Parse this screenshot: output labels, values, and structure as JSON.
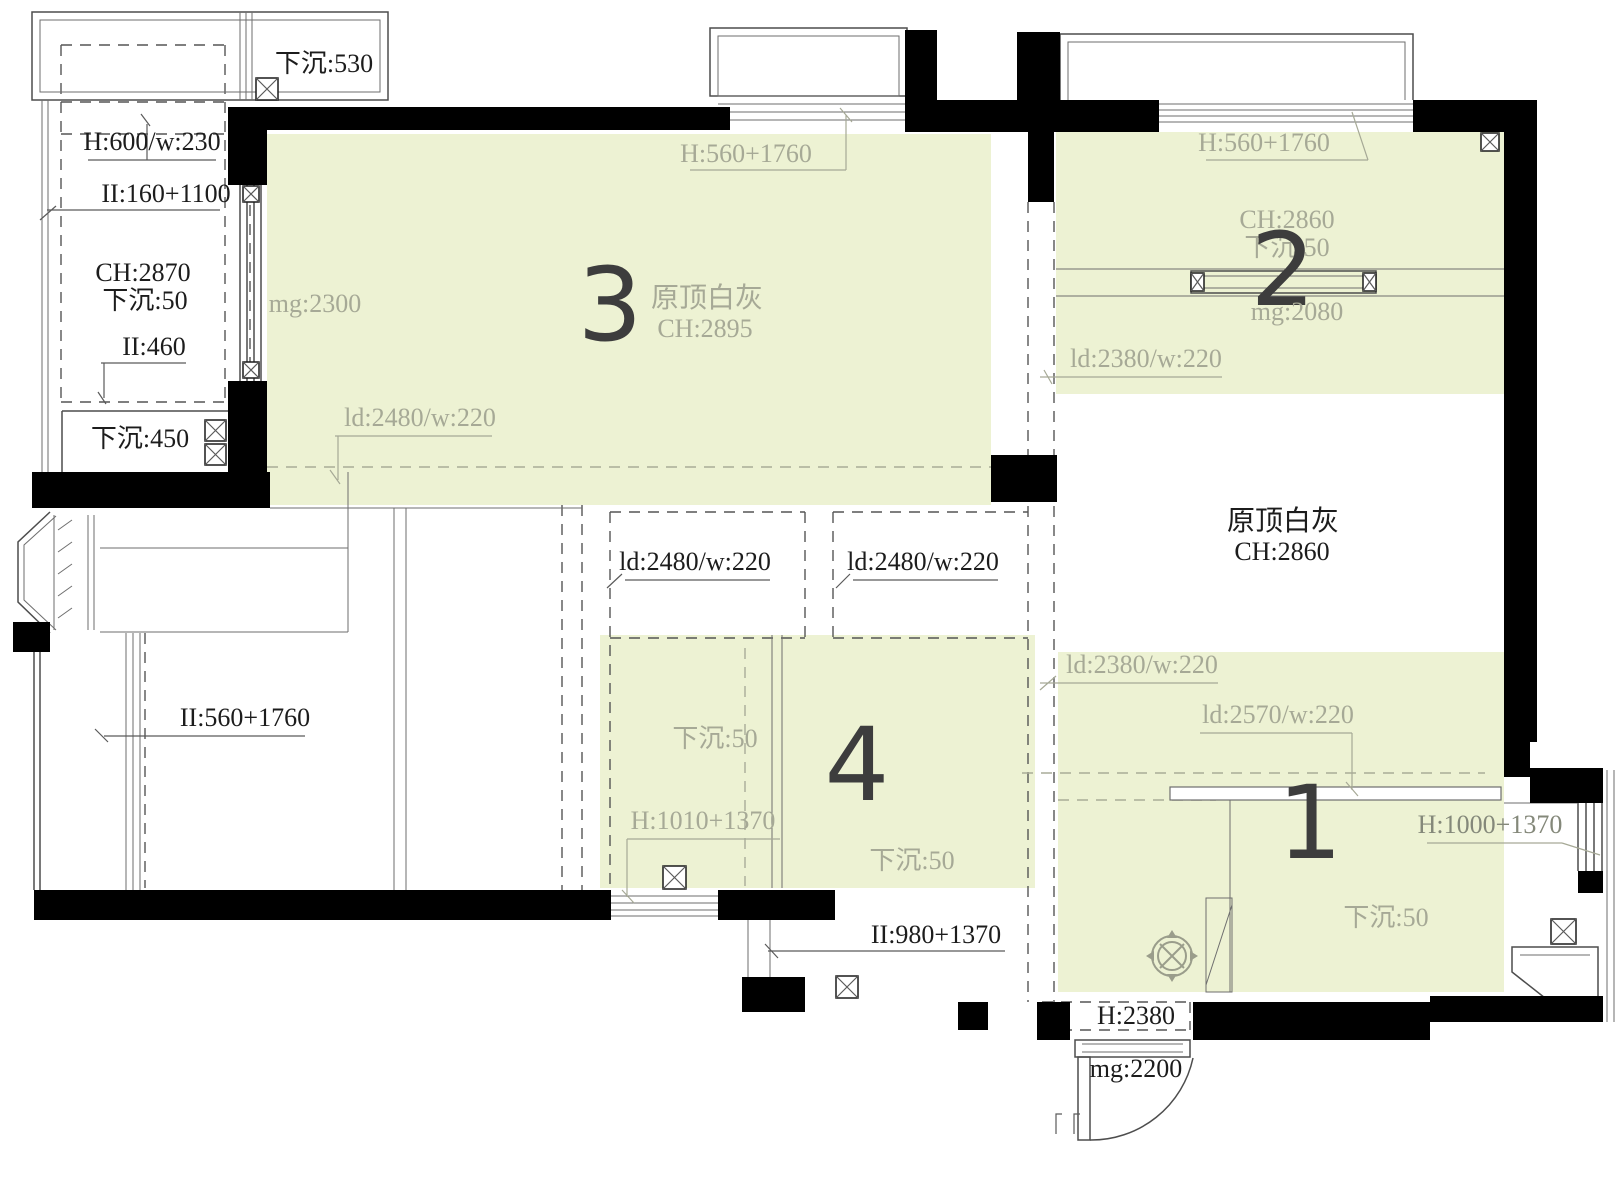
{
  "title": "天花吊顶平面图",
  "colors": {
    "zone_fill": "#edf2d3",
    "zone_text": "#a6a996",
    "ink": "#1c1c1c",
    "number": "#3d3d3d",
    "wall": "#000000"
  },
  "zones": {
    "z1": {
      "number": "1",
      "ld_a": "ld:2380/w:220",
      "ld_b": "ld:2570/w:220",
      "sink": "下沉:50",
      "window": "H:1000+1370"
    },
    "z2": {
      "number": "2",
      "window_top": "H:560+1760",
      "ch": "CH:2860",
      "sink": "下沉:50",
      "mg": "mg:2080",
      "ld": "ld:2380/w:220"
    },
    "z3": {
      "number": "3",
      "window_top": "H:560+1760",
      "finish": "原顶白灰",
      "ch": "CH:2895",
      "mg": "mg:2300",
      "ld": "ld:2480/w:220"
    },
    "z4": {
      "number": "4",
      "sink_left": "下沉:50",
      "window_left": "H:1010+1370",
      "sink_right": "下沉:50",
      "door_right": "II:980+1370"
    }
  },
  "dining": {
    "finish": "原顶白灰",
    "ch": "CH:2860"
  },
  "corridor": {
    "ld_left": "ld:2480/w:220",
    "ld_right": "ld:2480/w:220"
  },
  "balcony_top": {
    "sink": "下沉:530"
  },
  "utility": {
    "beam": "H:600/w:230",
    "window": "II:160+1100",
    "ch": "CH:2870",
    "sink": "下沉:50",
    "door": "II:460",
    "sink2": "下沉:450"
  },
  "balcony_left": {
    "window": "II:560+1760"
  },
  "entry": {
    "door_height": "H:2380",
    "mg": "mg:2200"
  }
}
